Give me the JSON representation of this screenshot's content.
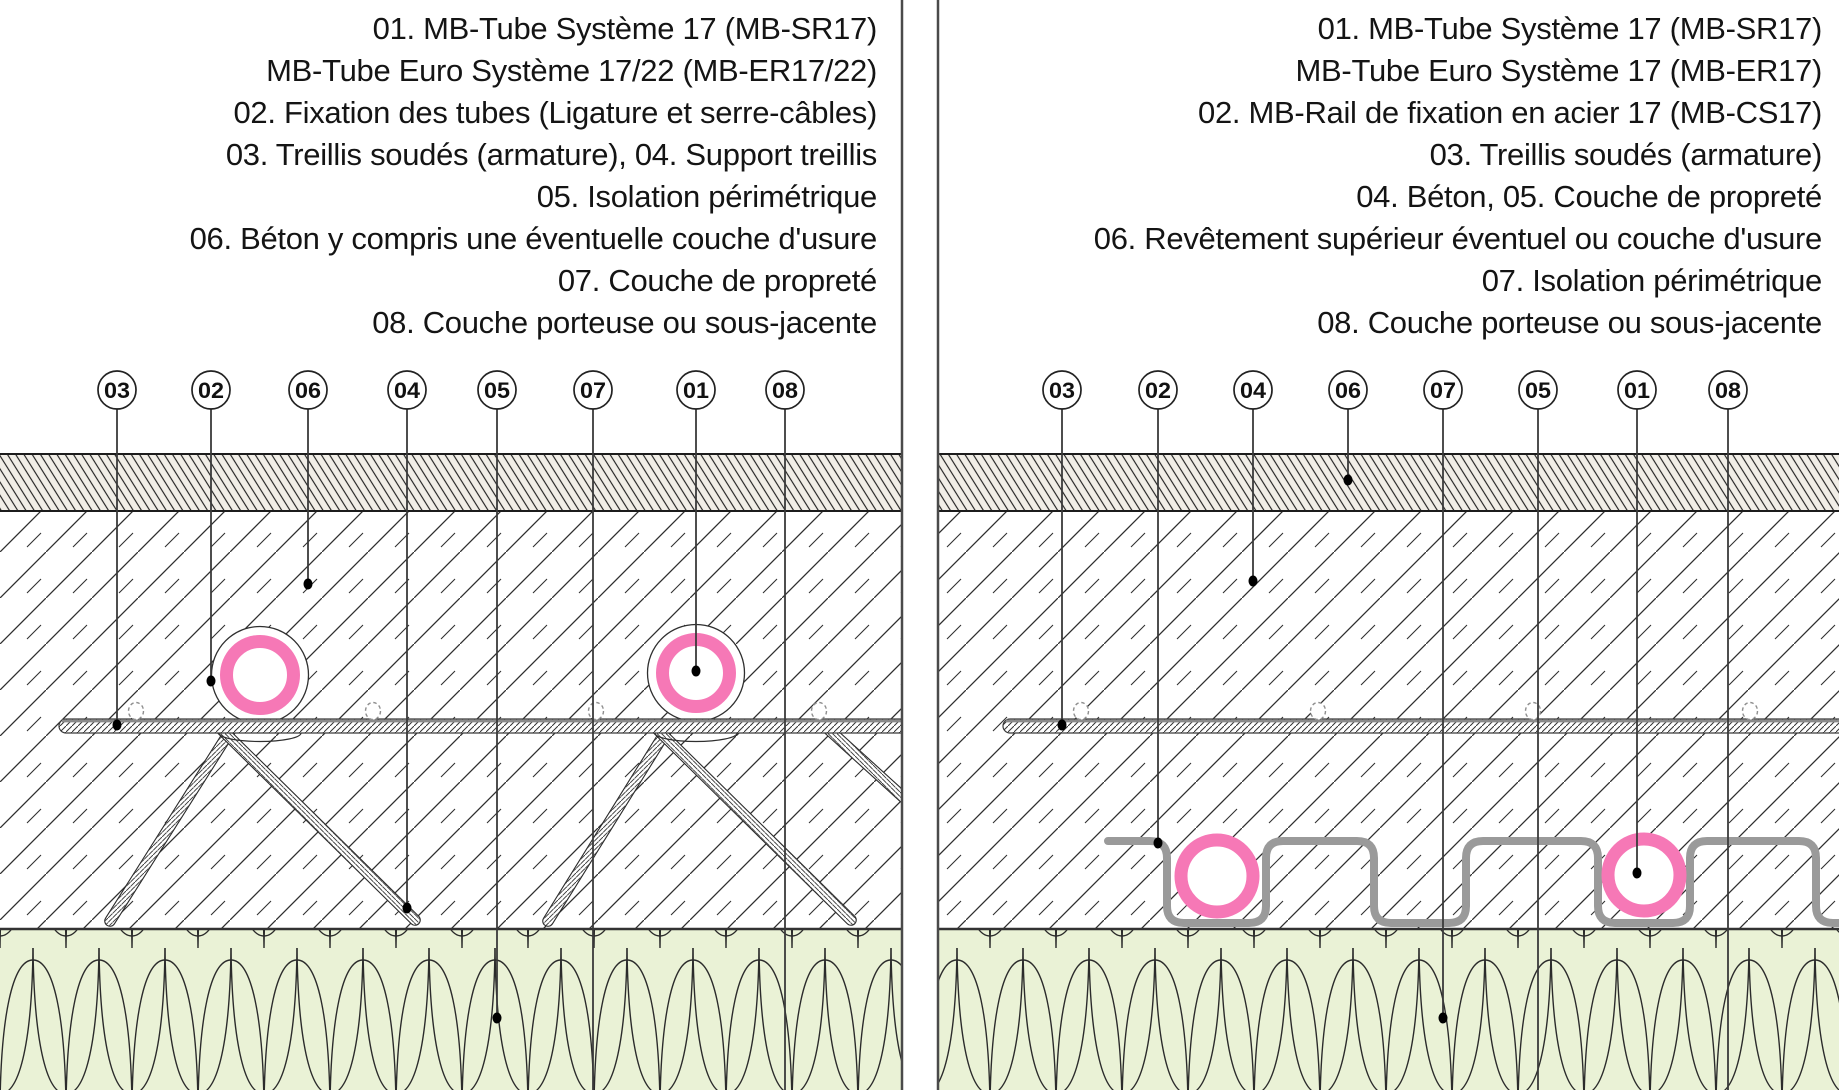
{
  "diagram_title": "MB floor heating system cross-sections",
  "colors": {
    "tube_pink": "#F678B6",
    "insulation_green": "#EAF2D6",
    "rail_gray": "#9A9A9A",
    "band_fill": "#F1EEE7",
    "hatch_dark": "#2E2E2E",
    "divider_gray": "#4A4A4A"
  },
  "panel_left": {
    "legend_lines": [
      "01. MB-Tube Système 17 (MB-SR17)",
      "MB-Tube Euro Système 17/22 (MB-ER17/22)",
      "02. Fixation des tubes (Ligature et serre-câbles)",
      "03. Treillis soudés (armature), 04. Support treillis",
      "05. Isolation périmétrique",
      "06. Béton y compris une éventuelle couche d'usure",
      "07. Couche de propreté",
      "08. Couche porteuse ou sous-jacente"
    ],
    "callouts": [
      "03",
      "02",
      "06",
      "04",
      "05",
      "07",
      "01",
      "08"
    ]
  },
  "panel_right": {
    "legend_lines": [
      "01. MB-Tube Système 17 (MB-SR17)",
      "MB-Tube Euro Système 17 (MB-ER17)",
      "02. MB-Rail de fixation en acier 17 (MB-CS17)",
      "03. Treillis soudés (armature)",
      "04. Béton, 05. Couche de propreté",
      "06. Revêtement supérieur éventuel ou couche d'usure",
      "07. Isolation périmétrique",
      "08. Couche porteuse ou sous-jacente"
    ],
    "callouts": [
      "03",
      "02",
      "04",
      "06",
      "07",
      "05",
      "01",
      "08"
    ]
  }
}
